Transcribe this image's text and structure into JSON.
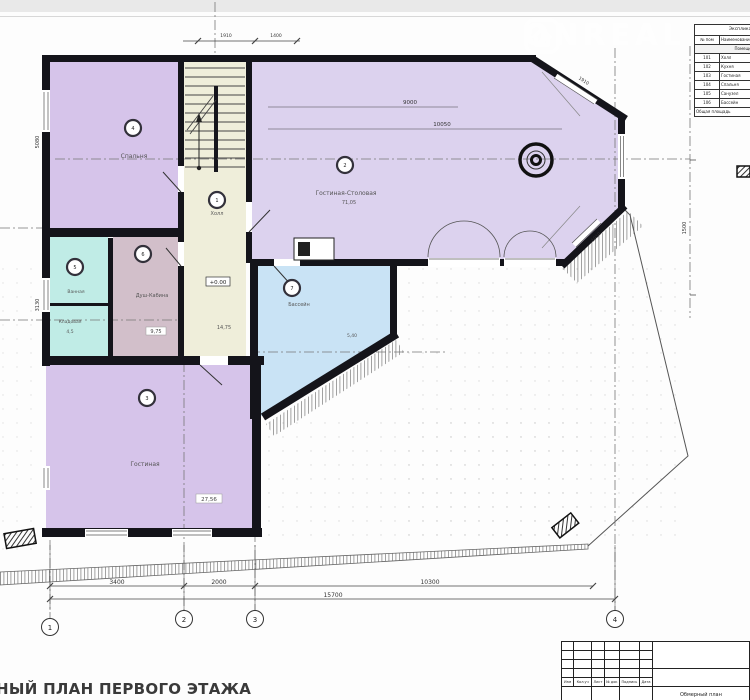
{
  "watermark": {
    "text": "ONREAL"
  },
  "schedule": {
    "title": "Экспликация помещений",
    "col_no": "№ пом",
    "col_name": "Наименование",
    "band": "Помещения 1-го этажа",
    "rows": [
      {
        "no": "101",
        "name": "Холл"
      },
      {
        "no": "102",
        "name": "Кухня"
      },
      {
        "no": "103",
        "name": "Гостиная"
      },
      {
        "no": "104",
        "name": "Спальня"
      },
      {
        "no": "105",
        "name": "Санузел"
      },
      {
        "no": "106",
        "name": "Бассейн"
      }
    ],
    "footer": "Общая площадь"
  },
  "rooms": {
    "hall": {
      "num": "1",
      "label": "Холл",
      "area": "14,75",
      "elevation": "+0.00"
    },
    "living_dining": {
      "num": "2",
      "label": "Гостиная-Столовая",
      "area": "71,05"
    },
    "living2": {
      "num": "3",
      "label": "Гостиная",
      "area": "27,56"
    },
    "bedroom": {
      "num": "4",
      "label": "Спальня"
    },
    "bath": {
      "num": "5",
      "label": "Ванная"
    },
    "storage": {
      "label": "Кладовая",
      "area": "4,5"
    },
    "shower": {
      "num": "6",
      "label": "Душ-Кабина",
      "area": "9,75"
    },
    "pool": {
      "num": "7",
      "label": "Бассейн",
      "area": "5,40"
    }
  },
  "dims": {
    "bottom": [
      "3400",
      "2000",
      "10300"
    ],
    "total": "15700",
    "top_a": "1910",
    "top_b": "1400",
    "left_a": "5080",
    "left_b": "3130",
    "right": "1500",
    "interior_a": "9000",
    "interior_b": "10050",
    "bay_a": "1910",
    "bay_b": "1910"
  },
  "axes": [
    "1",
    "2",
    "3",
    "4"
  ],
  "footer": {
    "title": "НЫЙ ПЛАН ПЕРВОГО ЭТАЖА"
  },
  "title_block": {
    "labels": [
      "Изм",
      "Кол.уч",
      "Лист",
      "№ док",
      "Подпись",
      "Дата"
    ],
    "note": "Обмерный план"
  }
}
